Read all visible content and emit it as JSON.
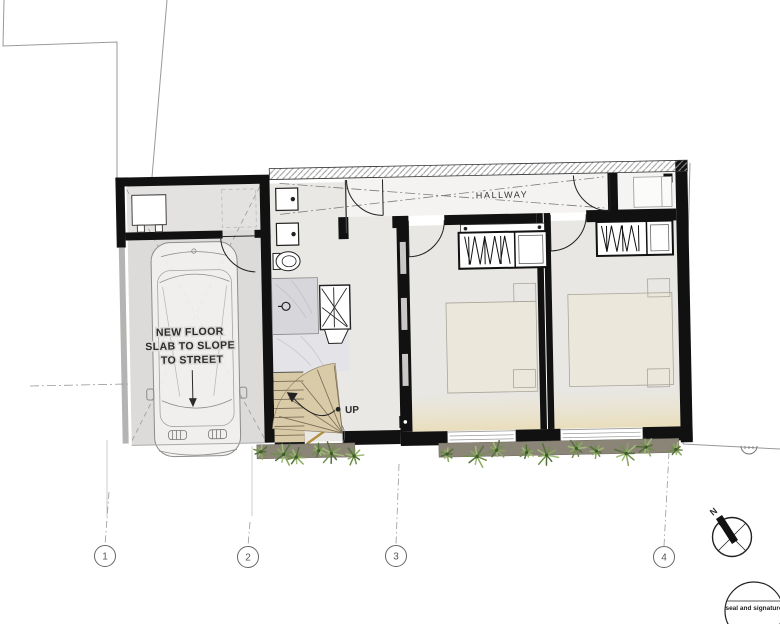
{
  "plan": {
    "garage_note_lines": [
      "NEW FLOOR",
      "SLAB TO SLOPE",
      "TO STREET"
    ],
    "hallway_label": "HALLWAY",
    "stairs_label": "UP",
    "north_label": "N",
    "seal_label": "seal and signature",
    "grid_labels": [
      "1",
      "2",
      "3",
      "4"
    ],
    "colors": {
      "wall": "#111111",
      "garage_floor": "#dcdbd9",
      "room_floor": "#e8e7e4",
      "hallway_floor": "#f4f3f1",
      "bath_floor": "#e9e8e5",
      "stair_wood": "#d9caa8",
      "soil": "#8b8577",
      "plant_greens": [
        "#55713b",
        "#6f8f4a",
        "#89a85e",
        "#9fbc74"
      ],
      "window_glow": "#ece2c6"
    }
  }
}
